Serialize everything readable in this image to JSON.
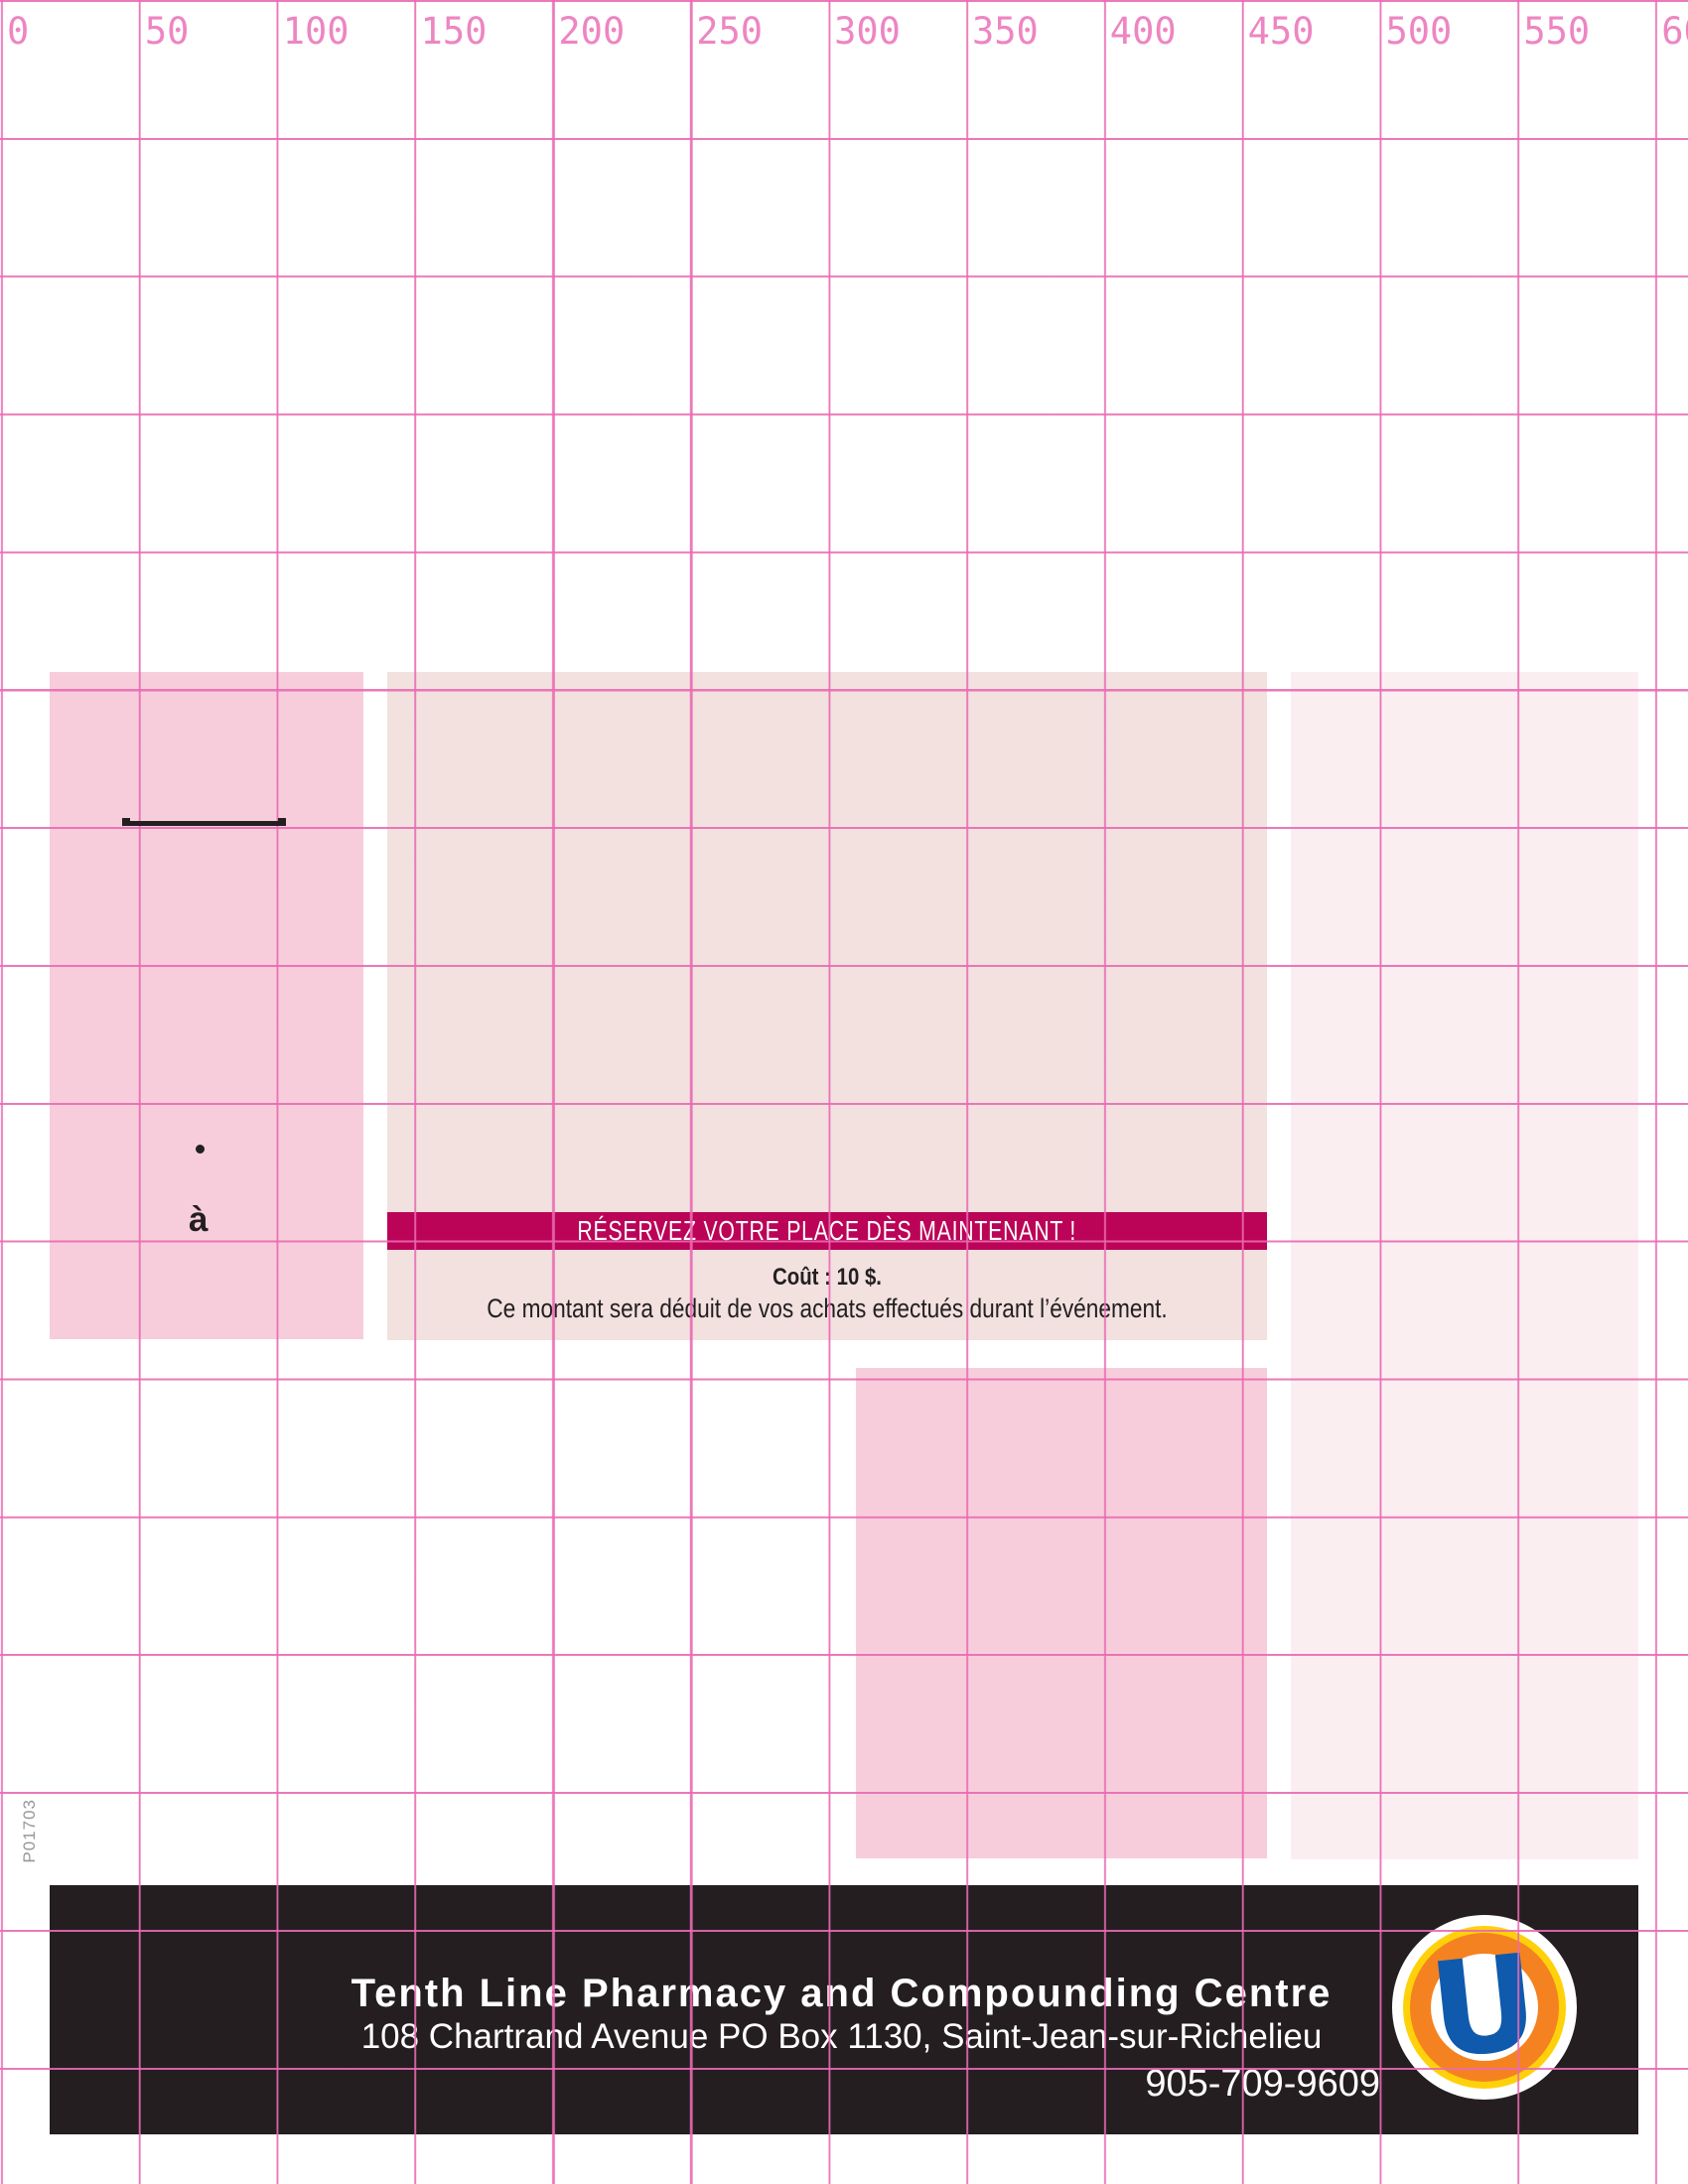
{
  "ruler": {
    "tick_labels": [
      "0",
      "50",
      "100",
      "150",
      "200",
      "250",
      "300",
      "350",
      "400",
      "450",
      "500",
      "550",
      "600"
    ]
  },
  "proof_code": {
    "text": "P01703"
  },
  "annotations": {
    "bullet": "•",
    "accent_word": "à"
  },
  "banner": {
    "text": "RÉSERVEZ VOTRE PLACE DÈS MAINTENANT !"
  },
  "pricing": {
    "cost": "Coût : 10 $.",
    "note": "Ce montant sera déduit de vos achats effectués durant l’événement."
  },
  "footer": {
    "name": "Tenth Line Pharmacy and Compounding Centre",
    "address": "108 Chartrand Avenue PO Box 1130, Saint-Jean-sur-Richelieu",
    "phone": "905-709-9609",
    "logo_letter": "U"
  },
  "colors": {
    "grid_line": "#e96ab2",
    "ruler_text": "#ee85c2",
    "block_pink": "#f8cddb",
    "block_blush": "#f2e1df",
    "block_pale": "#fbeef1",
    "banner_magenta": "#bb0457",
    "ink": "#231f20",
    "footer_black": "#241e21",
    "proof_gray": "#99969a",
    "logo_yellow": "#ffd10a",
    "logo_orange": "#f58220",
    "logo_blue": "#0f5aad"
  }
}
